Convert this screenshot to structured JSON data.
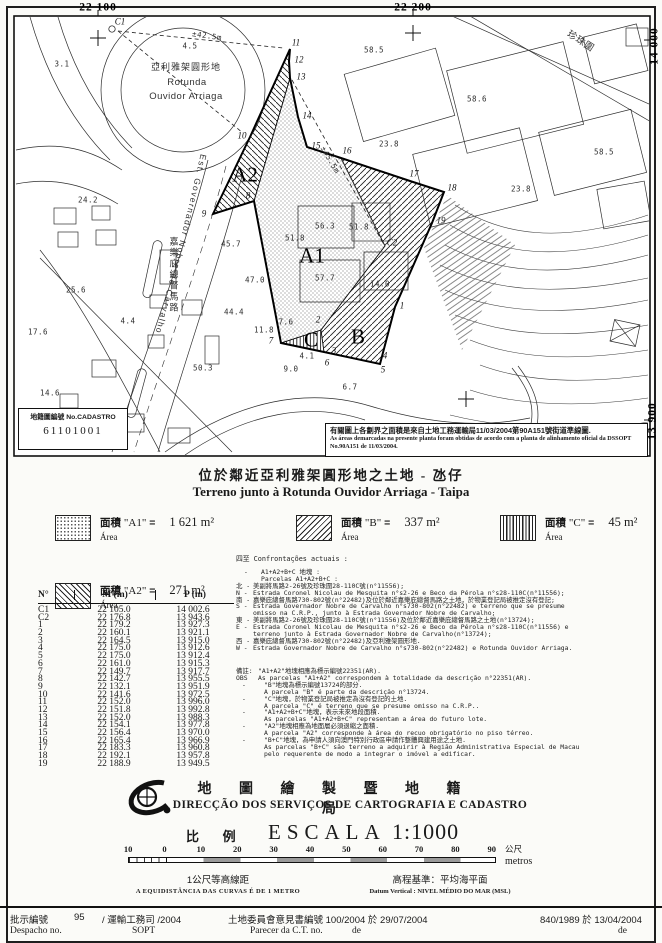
{
  "map": {
    "street_pt": "Est. Governador Nobre de Carvalho",
    "cadastro_box": {
      "label": "地籍圖編號 No.CADASTRO",
      "number": "61101001"
    },
    "note_box": {
      "zh": "有關圖上各劃界之面積是來自土地工務運輸局11/03/2004第90A151號街道準線圖.",
      "pt": "As áreas demarcadas na presente planta foram obtidas de acordo com a planta de alinhamento oficial da DSSOPT No.90A151 de 11/03/2004."
    },
    "labels": [
      {
        "x": 98,
        "y": 8,
        "t": "22 100",
        "cls": "g"
      },
      {
        "x": 413,
        "y": 8,
        "t": "22 200",
        "cls": "g"
      },
      {
        "x": 655,
        "y": 46,
        "t": "14 000",
        "cls": "g",
        "rot": -90
      },
      {
        "x": 653,
        "y": 421,
        "t": "13 900",
        "cls": "g",
        "rot": -90
      },
      {
        "x": 62,
        "y": 64,
        "t": "3.1"
      },
      {
        "x": 190,
        "y": 46,
        "t": "4.5"
      },
      {
        "x": 186,
        "y": 68,
        "t": "亞利雅架圓形地",
        "cls": "t"
      },
      {
        "x": 187,
        "y": 83,
        "t": "Rotunda",
        "cls": "t2"
      },
      {
        "x": 186,
        "y": 97,
        "t": "Ouvidor Arriaga",
        "cls": "t2"
      },
      {
        "x": 207,
        "y": 36,
        "t": "±42.5m",
        "rot": 8
      },
      {
        "x": 330,
        "y": 160,
        "t": "±45.5m",
        "rot": 60
      },
      {
        "x": 88,
        "y": 200,
        "t": "24.2"
      },
      {
        "x": 76,
        "y": 290,
        "t": "25.6"
      },
      {
        "x": 38,
        "y": 332,
        "t": "17.6"
      },
      {
        "x": 50,
        "y": 393,
        "t": "14.6"
      },
      {
        "x": 128,
        "y": 321,
        "t": "4.4"
      },
      {
        "x": 231,
        "y": 244,
        "t": "45.7"
      },
      {
        "x": 255,
        "y": 280,
        "t": "47.0"
      },
      {
        "x": 234,
        "y": 312,
        "t": "44.4"
      },
      {
        "x": 264,
        "y": 330,
        "t": "11.8"
      },
      {
        "x": 286,
        "y": 322,
        "t": "7.6"
      },
      {
        "x": 203,
        "y": 368,
        "t": "50.3"
      },
      {
        "x": 307,
        "y": 356,
        "t": "4.1"
      },
      {
        "x": 291,
        "y": 369,
        "t": "9.0"
      },
      {
        "x": 350,
        "y": 387,
        "t": "6.7"
      },
      {
        "x": 325,
        "y": 226,
        "t": "56.3"
      },
      {
        "x": 359,
        "y": 227,
        "t": "51.8"
      },
      {
        "x": 295,
        "y": 238,
        "t": "51.8"
      },
      {
        "x": 325,
        "y": 278,
        "t": "57.7"
      },
      {
        "x": 380,
        "y": 284,
        "t": "14.0"
      },
      {
        "x": 374,
        "y": 50,
        "t": "58.5"
      },
      {
        "x": 477,
        "y": 99,
        "t": "58.6"
      },
      {
        "x": 389,
        "y": 144,
        "t": "23.8"
      },
      {
        "x": 604,
        "y": 152,
        "t": "58.5"
      },
      {
        "x": 521,
        "y": 189,
        "t": "23.8"
      },
      {
        "x": 245,
        "y": 175,
        "t": "A2",
        "cls": "A"
      },
      {
        "x": 312,
        "y": 256,
        "t": "A1",
        "cls": "A"
      },
      {
        "x": 358,
        "y": 337,
        "t": "B",
        "cls": "A"
      },
      {
        "x": 311,
        "y": 340,
        "t": "C",
        "cls": "A"
      },
      {
        "x": 174,
        "y": 275,
        "t": "嘉樂庇總督馬路",
        "cls": "v"
      },
      {
        "x": 580,
        "y": 42,
        "t": "珍珠圍",
        "cls": "t2",
        "rot": 33
      },
      {
        "x": 120,
        "y": 22,
        "t": "C1",
        "cls": "p"
      },
      {
        "x": 242,
        "y": 136,
        "t": "10",
        "cls": "p"
      },
      {
        "x": 296,
        "y": 43,
        "t": "11",
        "cls": "p"
      },
      {
        "x": 299,
        "y": 60,
        "t": "12",
        "cls": "p"
      },
      {
        "x": 301,
        "y": 77,
        "t": "13",
        "cls": "p"
      },
      {
        "x": 307,
        "y": 116,
        "t": "14",
        "cls": "p"
      },
      {
        "x": 316,
        "y": 146,
        "t": "15",
        "cls": "p"
      },
      {
        "x": 347,
        "y": 151,
        "t": "16",
        "cls": "p"
      },
      {
        "x": 414,
        "y": 174,
        "t": "17",
        "cls": "p"
      },
      {
        "x": 452,
        "y": 188,
        "t": "18",
        "cls": "p"
      },
      {
        "x": 441,
        "y": 221,
        "t": "19",
        "cls": "p"
      },
      {
        "x": 392,
        "y": 243,
        "t": "C2",
        "cls": "p"
      },
      {
        "x": 402,
        "y": 306,
        "t": "1",
        "cls": "p"
      },
      {
        "x": 318,
        "y": 320,
        "t": "2",
        "cls": "p"
      },
      {
        "x": 334,
        "y": 351,
        "t": "3",
        "cls": "p"
      },
      {
        "x": 385,
        "y": 356,
        "t": "4",
        "cls": "p"
      },
      {
        "x": 383,
        "y": 370,
        "t": "5",
        "cls": "p"
      },
      {
        "x": 327,
        "y": 363,
        "t": "6",
        "cls": "p"
      },
      {
        "x": 271,
        "y": 341,
        "t": "7",
        "cls": "p"
      },
      {
        "x": 248,
        "y": 196,
        "t": "8",
        "cls": "p"
      },
      {
        "x": 204,
        "y": 214,
        "t": "9",
        "cls": "p"
      }
    ]
  },
  "title": {
    "zh": "位於鄰近亞利雅架圓形地之土地 - 氹仔",
    "pt": "Terreno junto à Rotunda Ouvidor Arriaga - Taipa"
  },
  "legend": {
    "items": [
      {
        "zh": "面積",
        "name": "\"A1\"",
        "eq": "=",
        "value": "1 621 m²",
        "pt": "Área"
      },
      {
        "zh": "面積",
        "name": "\"B\"",
        "eq": "=",
        "value": "337 m²",
        "pt": "Área"
      },
      {
        "zh": "面積",
        "name": "\"C\"",
        "eq": "=",
        "value": "45 m²",
        "pt": "Área"
      },
      {
        "zh": "面積",
        "name": "\"A2\"",
        "eq": "=",
        "value": "271 m²",
        "pt": "Área"
      }
    ]
  },
  "confrontations": {
    "heading": "四至 Confrontações actuais :",
    "lines": [
      {
        "pre": "-",
        "text": "A1+A2+B+C 地塊 :",
        "ind": 1
      },
      {
        "pre": "",
        "text": "Parcelas A1+A2+B+C :",
        "ind": 1
      },
      {
        "pre": "北 -",
        "text": "美副將馬路2-26號及珍珠圍28-110C號(n°11556);"
      },
      {
        "pre": "N -",
        "text": "Estrada Coronel Nicolau de Mesquita n°s2-26 e Beco da Pérola n°s28-110C(n°11556);"
      },
      {
        "pre": "南 -",
        "text": "嘉樂庇總督馬路730-802號(n°22482)及位於鄰近嘉樂庇總督馬路之土地，於物業登記局被推定沒有登記;"
      },
      {
        "pre": "S -",
        "text": "Estrada Governador Nobre de Carvalho n°s730-802(n°22482) e terreno que se presume omisso na C.R.P., junto à Estrada Governador Nobre de Carvalho;"
      },
      {
        "pre": "東 -",
        "text": "美副將馬路2-26號及珍珠圍28-110C號(n°11556)及位於鄰近嘉樂庇總督馬路之土地(n°13724);"
      },
      {
        "pre": "E -",
        "text": "Estrada Coronel Nicolau de Mesquita n°s2-26 e Beco da Pérola n°s28-110C(n°11556) e terreno junto à Estrada Governador Nobre de Carvalho(n°13724);"
      },
      {
        "pre": "西 -",
        "text": "嘉樂庇總督馬路730-802號(n°22482)及亞利雅架圓形地."
      },
      {
        "pre": "W -",
        "text": "Estrada Governador Nobre de Carvalho n°s730-802(n°22482) e Rotunda Ouvidor Arriaga."
      }
    ]
  },
  "notes": {
    "lines": [
      {
        "pre": "備註:",
        "text": "\"A1+A2\"地塊相應為標示編號22351(AR)."
      },
      {
        "pre": "OBS",
        "text": "As parcelas \"A1+A2\" correspondem à totalidade da descrição n°22351(AR)."
      },
      {
        "pre": "-",
        "text": "\"B\"地塊為標示編號13724的部分.",
        "ind": 1
      },
      {
        "pre": "",
        "text": "A parcela \"B\" é parte da descrição n°13724.",
        "ind": 1
      },
      {
        "pre": "-",
        "text": "\"C\"地塊，於物業登記局被推定為沒有登記的土地.",
        "ind": 1
      },
      {
        "pre": "",
        "text": "A parcela \"C\" é terreno que se presume omisso na C.R.P..",
        "ind": 1
      },
      {
        "pre": "-",
        "text": "\"A1+A2+B+C\"地塊，表示未來地段面積.",
        "ind": 1
      },
      {
        "pre": "",
        "text": "As parcelas \"A1+A2+B+C\" representam a área do futuro lote.",
        "ind": 1
      },
      {
        "pre": "-",
        "text": "\"A2\"地塊相應為地面層必須退縮之面積.",
        "ind": 1
      },
      {
        "pre": "",
        "text": "A parcela \"A2\" corresponde à área do recuo obrigatório no piso térreo.",
        "ind": 1
      },
      {
        "pre": "-",
        "text": "\"B+C\"地塊，為申請人須向澳門特別行政區申請作整體興建用途之土地.",
        "ind": 1
      },
      {
        "pre": "",
        "text": "As parcelas \"B+C\" são terreno a adquirir à Região Administrativa Especial de Macau pelo requerente de modo a integrar o imóvel a edificar.",
        "ind": 1
      }
    ]
  },
  "table": {
    "headers": {
      "n": "N°",
      "m": "M (m)",
      "p": "P (m)"
    },
    "rows": [
      {
        "n": "C1",
        "m": "22 105.0",
        "p": "14 002.6"
      },
      {
        "n": "C2",
        "m": "22 176.8",
        "p": "13 943.6"
      },
      {
        "n": "1",
        "m": "22 179.2",
        "p": "13 927.3"
      },
      {
        "n": "2",
        "m": "22 160.1",
        "p": "13 921.1"
      },
      {
        "n": "3",
        "m": "22 164.5",
        "p": "13 915.0"
      },
      {
        "n": "4",
        "m": "22 175.0",
        "p": "13 912.6"
      },
      {
        "n": "5",
        "m": "22 175.0",
        "p": "13 912.4"
      },
      {
        "n": "6",
        "m": "22 161.0",
        "p": "13 915.3"
      },
      {
        "n": "7",
        "m": "22 149.7",
        "p": "13 917.7"
      },
      {
        "n": "8",
        "m": "22 142.7",
        "p": "13 955.5"
      },
      {
        "n": "9",
        "m": "22 132.1",
        "p": "13 951.9"
      },
      {
        "n": "10",
        "m": "22 141.6",
        "p": "13 972.5"
      },
      {
        "n": "11",
        "m": "22 152.0",
        "p": "13 996.0"
      },
      {
        "n": "12",
        "m": "22 151.8",
        "p": "13 992.8"
      },
      {
        "n": "13",
        "m": "22 152.0",
        "p": "13 988.3"
      },
      {
        "n": "14",
        "m": "22 154.1",
        "p": "13 977.8"
      },
      {
        "n": "15",
        "m": "22 156.4",
        "p": "13 970.0"
      },
      {
        "n": "16",
        "m": "22 165.4",
        "p": "13 966.9"
      },
      {
        "n": "17",
        "m": "22 183.3",
        "p": "13 960.8"
      },
      {
        "n": "18",
        "m": "22 192.1",
        "p": "13 957.8"
      },
      {
        "n": "19",
        "m": "22 188.9",
        "p": "13 949.5"
      }
    ]
  },
  "org": {
    "zh": "地 圖 繪 製 暨 地 籍 局",
    "pt": "DIRECÇÃO DOS SERVIÇOS DE CARTOGRAFIA E CADASTRO"
  },
  "scale": {
    "label_zh": "比 例",
    "label_pt": "ESCALA",
    "ratio": "1:1000",
    "ticks": [
      "10",
      "0",
      "10",
      "20",
      "30",
      "40",
      "50",
      "60",
      "70",
      "80",
      "90"
    ],
    "unit_zh": "公尺",
    "unit_pt": "metros"
  },
  "datum": {
    "equidistance_zh": "1公尺等高線距",
    "equidistance_pt": "A EQUIDISTÂNCIA DAS CURVAS É DE 1 METRO",
    "vertical_zh": "高程基準：平均海平面",
    "vertical_pt": "Datum Vertical : NIVEL MÉDIO DO MAR (MSL)"
  },
  "footer": {
    "despacho_zh": "批示編號",
    "despacho_no": "95",
    "despacho_mid": "/ 運輸工務司 /2004",
    "despacho_pt": "Despacho no.",
    "despacho_sopt": "SOPT",
    "parecer_zh": "土地委員會意見書編號 100/2004 於 29/07/2004",
    "parecer_pt": "Parecer da C.T. no.",
    "parecer_de": "de",
    "ref_right": "840/1989 於 13/04/2004",
    "ref_right_de": "de"
  }
}
